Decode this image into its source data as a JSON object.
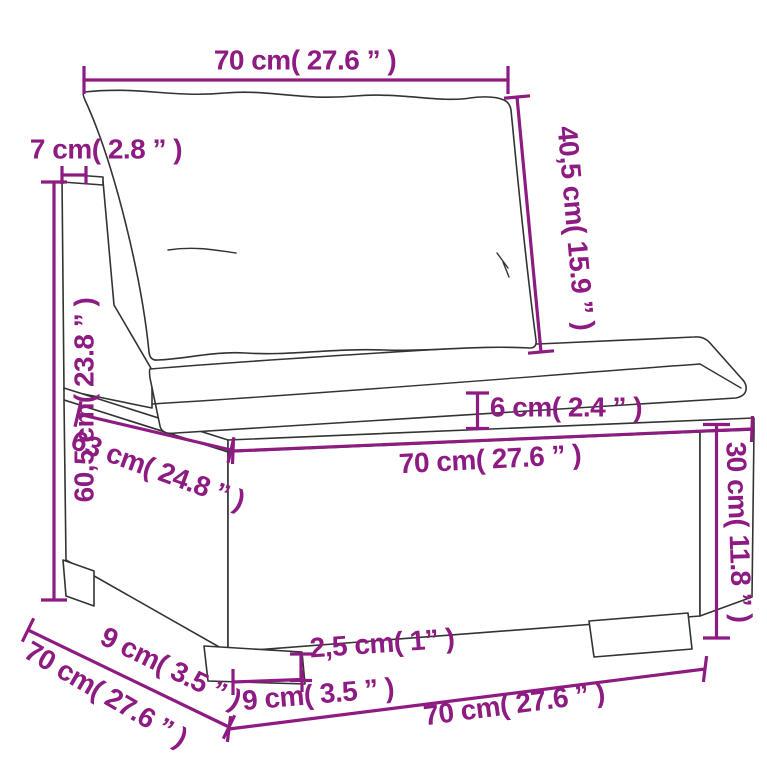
{
  "colors": {
    "dimension_magenta": "#8d1b81",
    "line_art": "#333333",
    "background": "#ffffff"
  },
  "dimensions": {
    "top_width": {
      "label": "70 cm( 27.6 ” )"
    },
    "back_frame_depth": {
      "label": "7 cm( 2.8 ” )"
    },
    "back_cushion_height": {
      "label": "40,5 cm( 15.9 ” )"
    },
    "back_height": {
      "label": "60,5 cm( 23.8 ” )"
    },
    "cushion_thickness": {
      "label": "6 cm( 2.4 ” )"
    },
    "seat_depth": {
      "label": "63 cm( 24.8 ” )"
    },
    "seat_width": {
      "label": "70 cm( 27.6 ” )"
    },
    "base_height": {
      "label": "30 cm( 11.8 ” )"
    },
    "foot_inset_depth": {
      "label": "9 cm( 3.5 ” )"
    },
    "total_depth": {
      "label": "70 cm( 27.6 ” )"
    },
    "foot_width": {
      "label": "9 cm( 3.5 ” )"
    },
    "foot_height": {
      "label": "2,5 cm( 1” )"
    },
    "total_width": {
      "label": "70 cm( 27.6 ” )"
    }
  }
}
